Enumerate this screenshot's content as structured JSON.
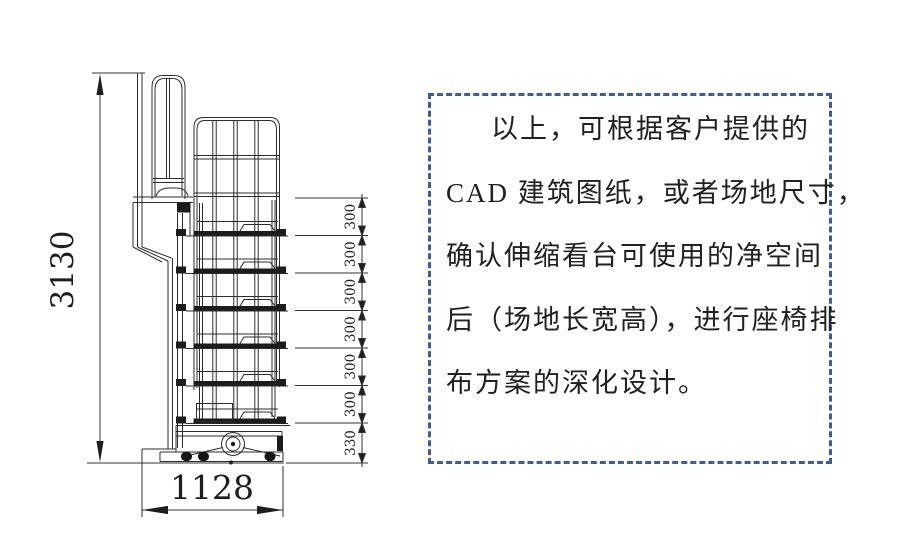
{
  "drawing": {
    "height_dim": "3130",
    "width_dim": "1128",
    "step_dims": [
      "300",
      "300",
      "300",
      "300",
      "300",
      "300",
      "330"
    ],
    "line_color": "#2d2d2d"
  },
  "note": {
    "border_color": "#3a5ca8",
    "text_color": "#212121",
    "lines": [
      "以上，可根据客户提供的",
      "CAD 建筑图纸，或者场地尺寸，",
      "确认伸缩看台可使用的净空间",
      "后（场地长宽高），进行座椅排",
      "布方案的深化设计。"
    ]
  }
}
